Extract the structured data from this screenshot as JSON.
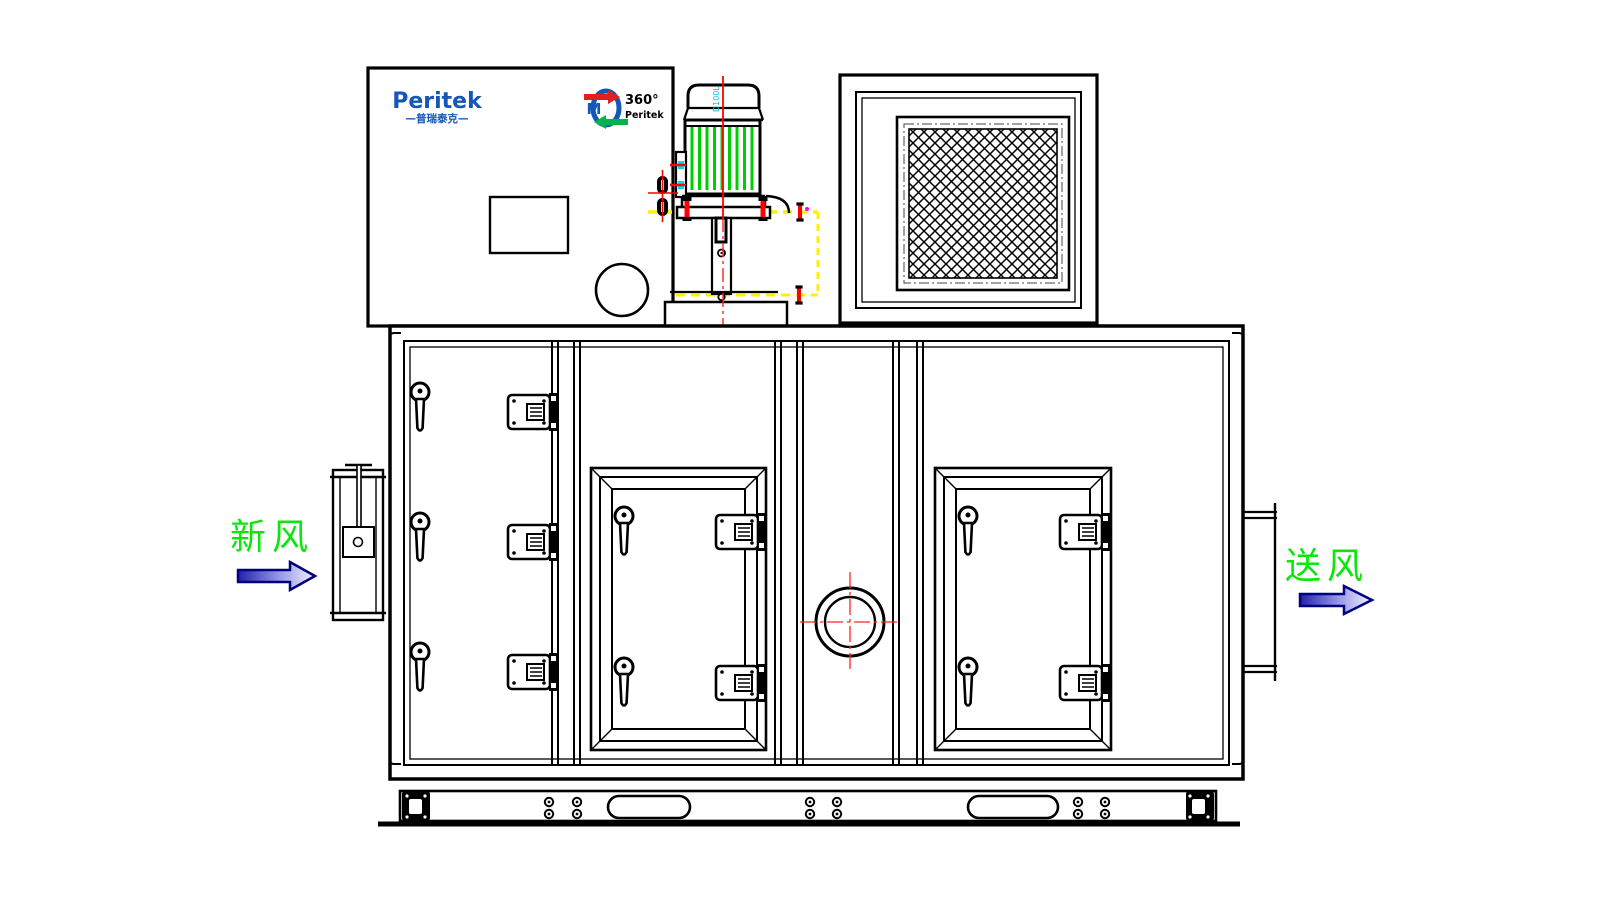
{
  "brand": {
    "logo_text": "Peritek",
    "logo_subtext": "—普瑞泰克—"
  },
  "rotor_logo": {
    "angle_text": "360°",
    "brand_text": "Peritek"
  },
  "motor": {
    "frame_label": "D100L"
  },
  "airflow": {
    "inlet_label": "新风",
    "outlet_label": "送风"
  },
  "colors": {
    "brand_blue": "#1457b8",
    "motor_stripe_green": "#00cc00",
    "airflow_label_green": "#0ce60c",
    "centerline_red": "#ff0000",
    "construction_yellow": "#ffef00",
    "motor_label_cyan": "#00c8d8",
    "arrow_outline_navy": "#000080",
    "logo_arrow_red": "#e02020",
    "logo_arrow_green": "#00b34d"
  }
}
